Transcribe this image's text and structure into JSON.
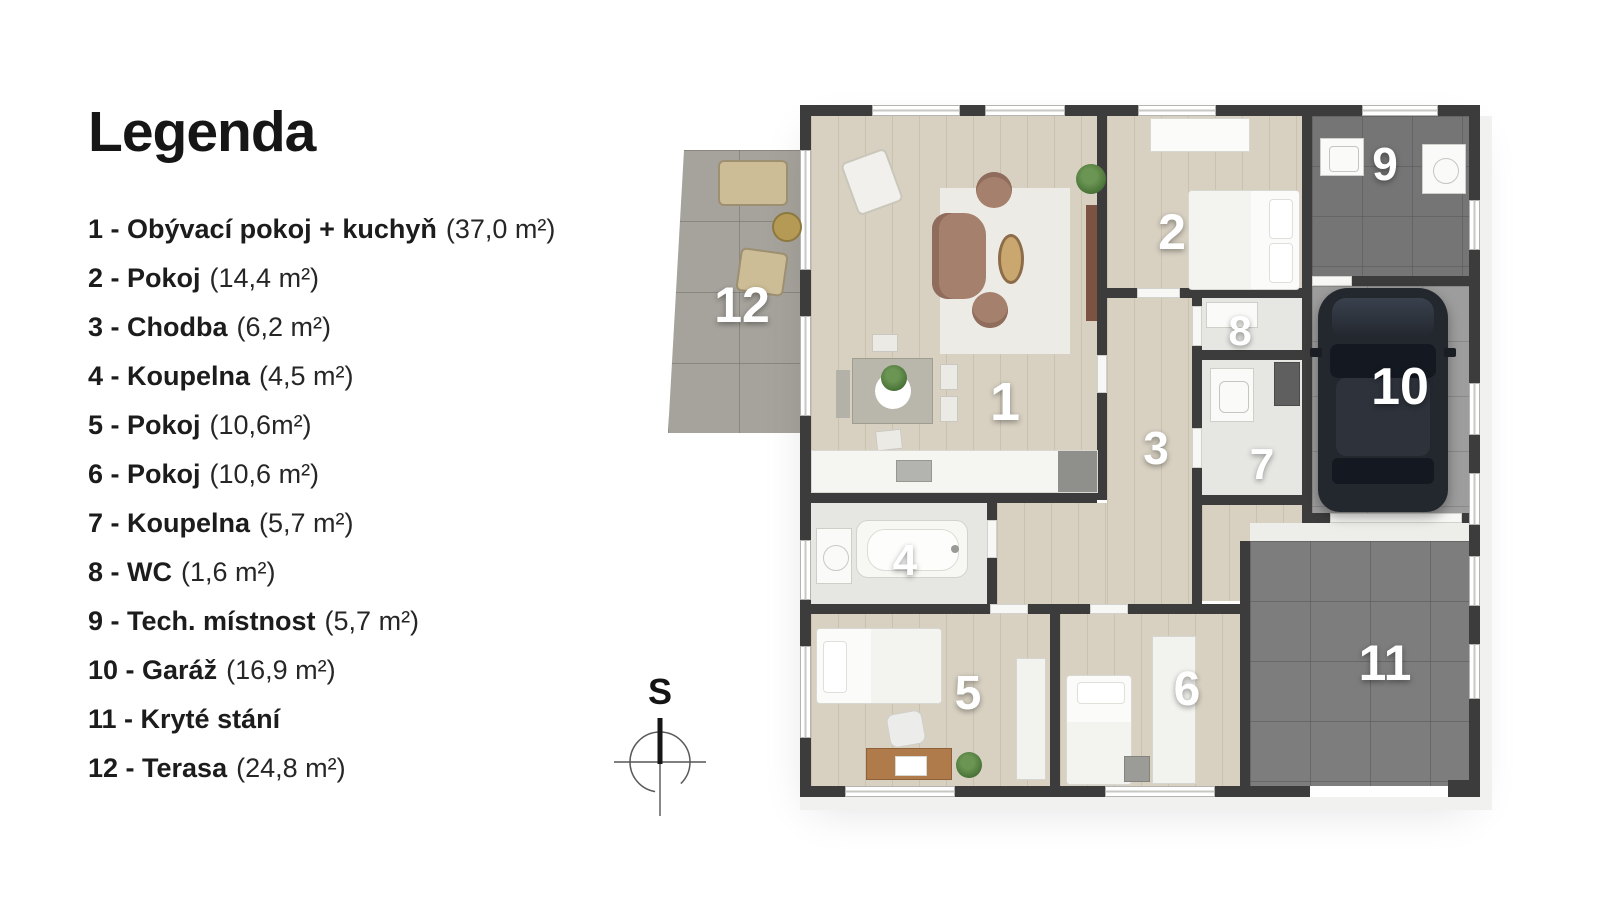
{
  "legend": {
    "title": "Legenda",
    "items": [
      {
        "label": "1 - Obývací pokoj + kuchyň",
        "area": "(37,0 m²)"
      },
      {
        "label": "2 - Pokoj",
        "area": "(14,4 m²)"
      },
      {
        "label": "3 - Chodba",
        "area": "(6,2 m²)"
      },
      {
        "label": "4 - Koupelna",
        "area": "(4,5 m²)"
      },
      {
        "label": "5 - Pokoj",
        "area": "(10,6m²)"
      },
      {
        "label": "6 - Pokoj",
        "area": "(10,6 m²)"
      },
      {
        "label": "7 - Koupelna",
        "area": "(5,7 m²)"
      },
      {
        "label": "8 - WC",
        "area": "(1,6 m²)"
      },
      {
        "label": "9 - Tech. místnost",
        "area": "(5,7 m²)"
      },
      {
        "label": "10 - Garáž",
        "area": "(16,9 m²)"
      },
      {
        "label": "11 - Kryté stání",
        "area": ""
      },
      {
        "label": "12 - Terasa",
        "area": "(24,8 m²)"
      }
    ]
  },
  "compass": {
    "label": "S"
  },
  "plan": {
    "type": "floor-plan",
    "room_numbers": [
      "1",
      "2",
      "3",
      "4",
      "5",
      "6",
      "7",
      "8",
      "9",
      "10",
      "11",
      "12"
    ],
    "colors": {
      "wall": "#3c3c3c",
      "wood_floor": "#d8d1c2",
      "bath_floor": "#e6e6e3",
      "terrace_floor": "#a6a39c",
      "garage_floor": "#9d9d9d",
      "parking_floor": "#7d7d7d",
      "tech_floor": "#757575",
      "car": "#23272e",
      "sofa": "#a5806d",
      "outdoor_furniture": "#cdbd97",
      "room_number_text": "#ffffff",
      "legend_text": "#1c1c1c"
    }
  }
}
